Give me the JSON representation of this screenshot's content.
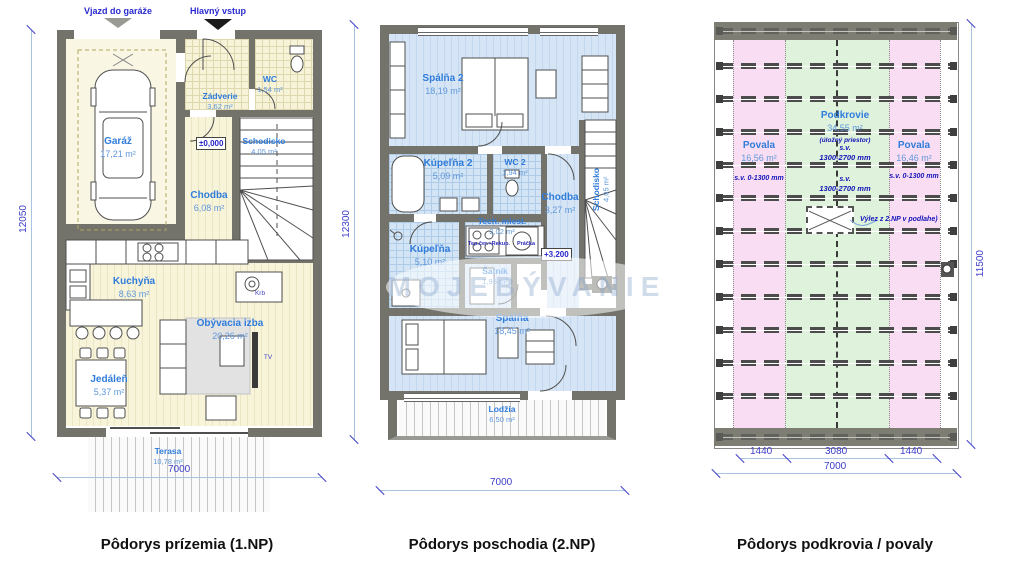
{
  "watermark": {
    "text": "MOJEBÝVANIE"
  },
  "plans": {
    "ground": {
      "caption": "Pôdorys prízemia (1.NP)",
      "entry_labels": {
        "garage": "Vjazd do garáže",
        "main": "Hlavný vstup"
      },
      "rooms": {
        "garaz": {
          "name": "Garáž",
          "area": "17,21 m²"
        },
        "zadverie": {
          "name": "Zádverie",
          "area": "3,62 m²"
        },
        "wc": {
          "name": "WC",
          "area": "1,54 m²"
        },
        "schodisko": {
          "name": "Schodisko",
          "area": "4,05 m²"
        },
        "chodba": {
          "name": "Chodba",
          "area": "6,08 m²"
        },
        "kuchyna": {
          "name": "Kuchyňa",
          "area": "8,63 m²"
        },
        "obyvacia": {
          "name": "Obývacia izba",
          "area": "20,26 m²"
        },
        "jedalen": {
          "name": "Jedáleň",
          "area": "5,37 m²"
        },
        "terasa": {
          "name": "Terasa",
          "area": "10,78 m²"
        }
      },
      "markers": {
        "level": "±0,000",
        "fireplace": "Krb",
        "tv": "TV"
      },
      "dims": {
        "height": "12050",
        "width": "7000"
      }
    },
    "second": {
      "caption": "Pôdorys poschodia (2.NP)",
      "rooms": {
        "spalna2": {
          "name": "Spálňa 2",
          "area": "18,19 m²"
        },
        "kupelna2": {
          "name": "Kúpeľňa 2",
          "area": "5,09 m²"
        },
        "wc2": {
          "name": "WC 2",
          "area": "1,94 m²"
        },
        "chodba": {
          "name": "Chodba",
          "area": "3,27 m²"
        },
        "schodisko": {
          "name": "Schodisko",
          "area": "4,05 m²"
        },
        "tech": {
          "name": "Tech. miest.",
          "area": "3,02 m²"
        },
        "kupelna": {
          "name": "Kúpeľňa",
          "area": "5,10 m²"
        },
        "satnik": {
          "name": "Šatník",
          "area": "1,95 m²"
        },
        "spalna": {
          "name": "Spálňa",
          "area": "18,45 m²"
        },
        "lodzia": {
          "name": "Lodžia",
          "area": "6,50 m²"
        }
      },
      "markers": {
        "level": "+3,200",
        "heatpump": "Tep.čer.+Rekup.",
        "washer": "Práčka"
      },
      "dims": {
        "height": "12300",
        "width": "7000"
      }
    },
    "attic": {
      "caption": "Pôdorys podkrovia / povaly",
      "rooms": {
        "povala_left": {
          "name": "Povala",
          "area": "16,56 m²",
          "note": "s.v. 0-1300 mm"
        },
        "podkrovie": {
          "name": "Podkrovie",
          "area": "34,55 m²",
          "note1": "(úložný priestor)",
          "note2": "s.v.",
          "note3": "1300-2700 mm"
        },
        "povala_right": {
          "name": "Povala",
          "area": "16,46 m²",
          "note": "s.v. 0-1300 mm"
        }
      },
      "center_note": {
        "line1": "s.v.",
        "line2": "1300-2700 mm"
      },
      "hatch_note": "Výlez z 2.NP v podlahe)",
      "dims": {
        "height": "11500",
        "seg1": "1440",
        "seg2": "3080",
        "seg3": "1440",
        "width": "7000"
      }
    }
  }
}
